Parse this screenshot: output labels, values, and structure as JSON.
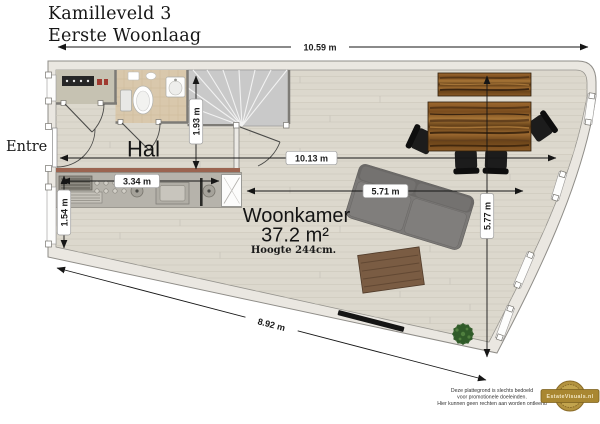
{
  "title": {
    "address": "Kamilleveld 3",
    "floor": "Eerste Woonlaag"
  },
  "rooms": {
    "entree": "Entree",
    "hal": "Hal",
    "woonkamer": "Woonkamer",
    "woonkamer_area": "37.2 m²",
    "woonkamer_height": "Hoogte 244cm."
  },
  "dimensions": {
    "overall_width": "10.59 m",
    "living_width": "10.13 m",
    "sofa_span": "5.71 m",
    "right_depth": "5.77 m",
    "hal_depth": "1.93 m",
    "kitchen_width": "3.34 m",
    "kitchen_depth": "1.54 m",
    "bottom_edge": "8.92 m"
  },
  "footer": {
    "disclaimer": [
      "Deze plattegrond is slechts bedoeld",
      "voor promotionele doeleinden.",
      "Hier kunnen geen rechten aan worden ontleend"
    ],
    "logo_text": "EstateVisuals.nl"
  },
  "colors": {
    "floor_wood": "#dcd8cd",
    "wall_fill": "#eae7e1",
    "closet_floor": "#c6c2b2",
    "toilet_floor": "#d9c8ac",
    "stairs_gray": "#c9c9c9",
    "kitchen_counter": "#b6b3ab",
    "accent_wall": "#9b6450",
    "sofa_gray": "#7a7876",
    "coffee_table": "#7a5c43",
    "tv_black": "#151515",
    "plant_green": "#35622c",
    "chair_black": "#1c1c1c",
    "table_wood": "#8a5a26",
    "logo_gold": "#a98731",
    "dimension_line": "#1a1a1a"
  }
}
